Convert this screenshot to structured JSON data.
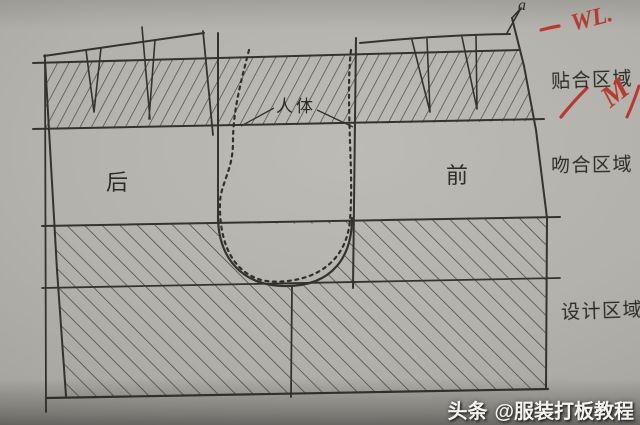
{
  "page": {
    "watermark": {
      "brand": "头条",
      "handle": "@服装打板教程"
    },
    "labels": {
      "zone_fit": "贴合区域",
      "zone_match": "吻合区域",
      "zone_design": "设计区域",
      "back": "后",
      "front": "前",
      "body": "人体",
      "point_a": "a"
    },
    "red": {
      "wl": "WL.",
      "m": "M"
    },
    "colors": {
      "paper": "#b2b0aa",
      "ink": "#34332e",
      "hatch": "#46443f",
      "red_pen": "#b8392f",
      "watermark_text": "#f4f3f0"
    }
  }
}
